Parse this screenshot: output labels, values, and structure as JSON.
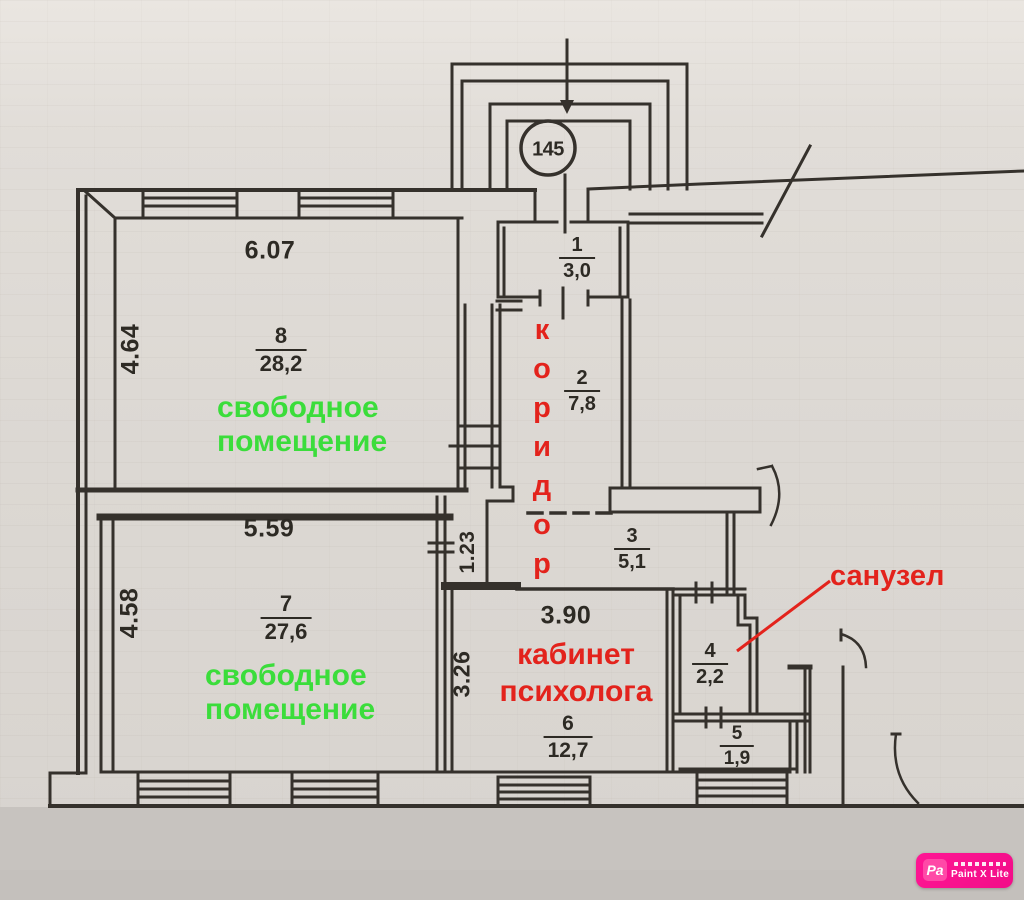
{
  "plan": {
    "entrance_label": "145",
    "rooms": {
      "room1": {
        "number": "1",
        "area": "3,0"
      },
      "room2": {
        "number": "2",
        "area": "7,8"
      },
      "room3": {
        "number": "3",
        "area": "5,1"
      },
      "room4": {
        "number": "4",
        "area": "2,2"
      },
      "room5": {
        "number": "5",
        "area": "1,9"
      },
      "room6": {
        "number": "6",
        "area": "12,7"
      },
      "room7": {
        "number": "7",
        "area": "27,6"
      },
      "room8": {
        "number": "8",
        "area": "28,2"
      }
    },
    "dimensions": {
      "room8_width": "6.07",
      "room8_depth": "4.64",
      "room7_width": "5.59",
      "room7_depth": "4.58",
      "room6_width": "3.90",
      "room6_depth": "3.26",
      "corridor_width": "1.23"
    },
    "annotations": {
      "corridor": "коридор",
      "office_line1": "кабинет",
      "office_line2": "психолога",
      "bathroom": "санузел",
      "free_room8_line1": "свободное",
      "free_room8_line2": "помещение",
      "free_room7_line1": "свободное",
      "free_room7_line2": "помещение"
    },
    "colors": {
      "ink": "#35312c",
      "annotation_red": "#e3231c",
      "annotation_green": "#3bdd3b",
      "paper": "#dcd8d3"
    }
  },
  "watermark": {
    "logo": "Pa",
    "label": "Paint X Lite",
    "color": "#f20d88"
  }
}
